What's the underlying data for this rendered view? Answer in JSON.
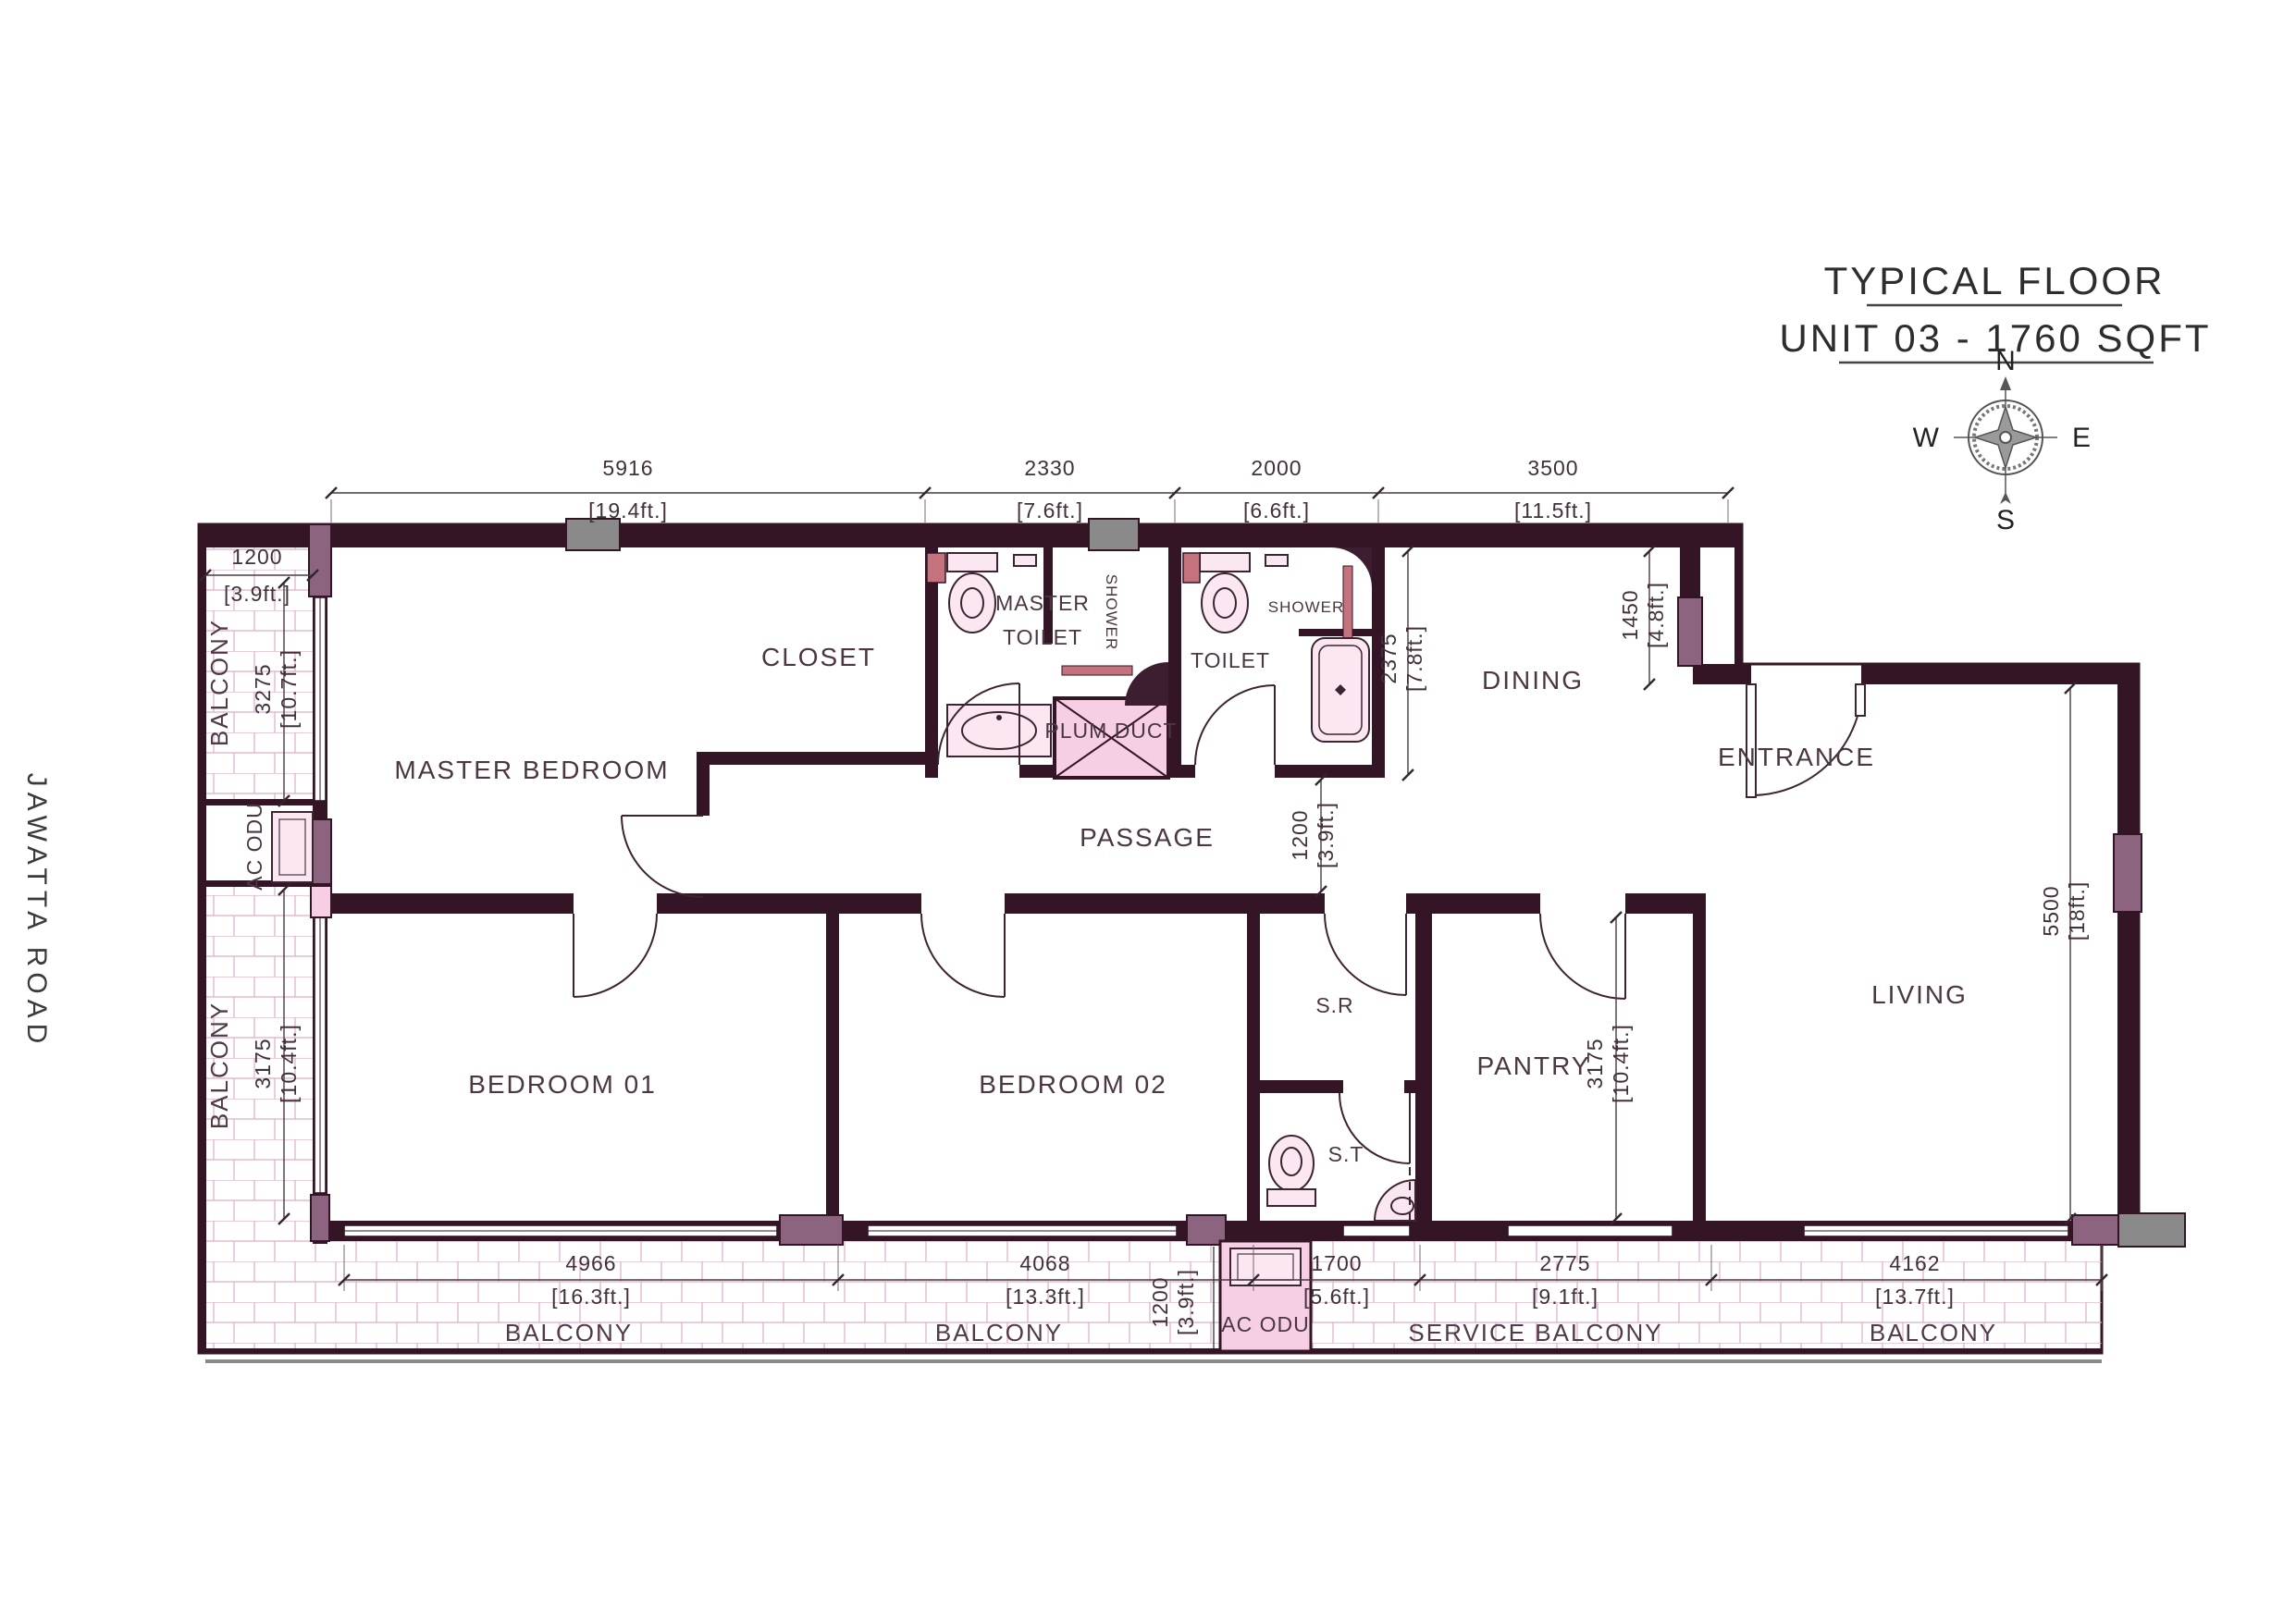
{
  "title": {
    "line1": "TYPICAL FLOOR",
    "line2": "UNIT 03 - 1760 SQFT"
  },
  "compass": {
    "n": "N",
    "e": "E",
    "s": "S",
    "w": "W"
  },
  "road": "JAWATTA ROAD",
  "labels": {
    "master_bedroom": "MASTER BEDROOM",
    "closet": "CLOSET",
    "master_toilet_1": "MASTER",
    "master_toilet_2": "TOILET",
    "shower_master": "SHOWER",
    "plum_duct": "PLUM DUCT",
    "toilet": "TOILET",
    "shower_toilet": "SHOWER",
    "dining": "DINING",
    "entrance": "ENTRANCE",
    "living": "LIVING",
    "passage": "PASSAGE",
    "bedroom1": "BEDROOM 01",
    "bedroom2": "BEDROOM 02",
    "sr": "S.R",
    "st": "S.T",
    "pantry": "PANTRY",
    "ac_odu_left": "AC ODU",
    "ac_odu_bottom": "AC ODU",
    "balcony_left_upper": "BALCONY",
    "balcony_left_lower": "BALCONY",
    "balcony_b1": "BALCONY",
    "balcony_b2": "BALCONY",
    "service_balcony": "SERVICE BALCONY",
    "balcony_b3": "BALCONY"
  },
  "dims": {
    "top": [
      {
        "mm": "5916",
        "ft": "[19.4ft.]"
      },
      {
        "mm": "2330",
        "ft": "[7.6ft.]"
      },
      {
        "mm": "2000",
        "ft": "[6.6ft.]"
      },
      {
        "mm": "3500",
        "ft": "[11.5ft.]"
      }
    ],
    "bottom": [
      {
        "mm": "4966",
        "ft": "[16.3ft.]"
      },
      {
        "mm": "4068",
        "ft": "[13.3ft.]"
      },
      {
        "mm": "1700",
        "ft": "[5.6ft.]"
      },
      {
        "mm": "2775",
        "ft": "[9.1ft.]"
      },
      {
        "mm": "4162",
        "ft": "[13.7ft.]"
      }
    ],
    "left_width": {
      "mm": "1200",
      "ft": "[3.9ft.]"
    },
    "left_upper": {
      "mm": "3275",
      "ft": "[10.7ft.]"
    },
    "left_lower": {
      "mm": "3175",
      "ft": "[10.4ft.]"
    },
    "balcony_depth": {
      "mm": "1200",
      "ft": "[3.9ft.]"
    },
    "passage": {
      "mm": "1200",
      "ft": "[3.9ft.]"
    },
    "dining_depth": {
      "mm": "2375",
      "ft": "[7.8ft.]"
    },
    "dining_right": {
      "mm": "1450",
      "ft": "[4.8ft.]"
    },
    "living_depth": {
      "mm": "5500",
      "ft": "[18ft.]"
    },
    "pantry_depth": {
      "mm": "3175",
      "ft": "[10.4ft.]"
    }
  },
  "colors": {
    "floor": "#f7cfe5",
    "balcony_grid": "#dcaeca",
    "wall": "#331526",
    "column": "#8d6480",
    "frame_gray": "#8a8a8a",
    "fixture_accent": "#c4737d"
  }
}
